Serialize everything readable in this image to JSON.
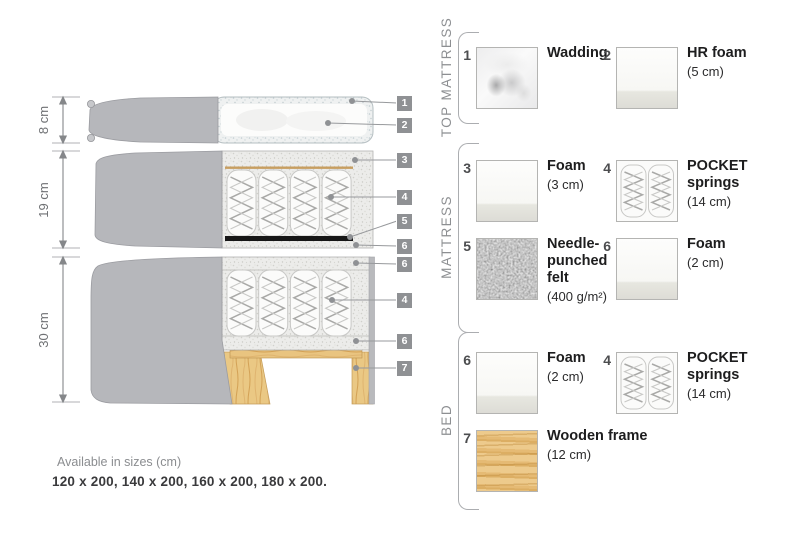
{
  "diagram": {
    "dimensions": [
      {
        "label": "8 cm"
      },
      {
        "label": "19 cm"
      },
      {
        "label": "30 cm"
      }
    ],
    "callouts": [
      {
        "n": "1"
      },
      {
        "n": "2"
      },
      {
        "n": "3"
      },
      {
        "n": "4"
      },
      {
        "n": "5"
      },
      {
        "n": "6"
      },
      {
        "n": "6"
      },
      {
        "n": "4"
      },
      {
        "n": "6"
      },
      {
        "n": "7"
      }
    ],
    "footer": {
      "line1": "Available in sizes (cm)",
      "line2": "120 x 200, 140 x 200, 160 x 200, 180 x 200."
    }
  },
  "legend": {
    "sections": [
      {
        "label": "TOP MATTRESS",
        "items": [
          {
            "num": "1",
            "name": "Wadding",
            "size": "",
            "swatch": "wadding-texture"
          },
          {
            "num": "2",
            "name": "HR foam",
            "size": "(5 cm)",
            "swatch": "foam-texture"
          }
        ]
      },
      {
        "label": "MATTRESS",
        "items": [
          {
            "num": "3",
            "name": "Foam",
            "size": "(3 cm)",
            "swatch": "foam-texture"
          },
          {
            "num": "4",
            "name": "POCKET springs",
            "size": "(14 cm)",
            "swatch": "pocket-springs-texture"
          },
          {
            "num": "5",
            "name": "Needle-punched felt",
            "size": "(400 g/m²)",
            "swatch": "felt-texture"
          },
          {
            "num": "6",
            "name": "Foam",
            "size": "(2 cm)",
            "swatch": "foam-texture"
          }
        ]
      },
      {
        "label": "BED",
        "items": [
          {
            "num": "6",
            "name": "Foam",
            "size": "(2 cm)",
            "swatch": "foam-texture"
          },
          {
            "num": "4",
            "name": "POCKET springs",
            "size": "(14 cm)",
            "swatch": "pocket-springs-texture"
          },
          {
            "num": "7",
            "name": "Wooden frame",
            "size": "(12 cm)",
            "swatch": "wood-texture"
          }
        ]
      }
    ]
  },
  "colors": {
    "fabric_gray": "#b6b7bb",
    "foam_speckle": "#ececea",
    "wood": "#e9c480",
    "felt": "#1c1c1c",
    "callout_tag": "#8f9194",
    "text_dark": "#231f20",
    "text_gray": "#8b8d90"
  }
}
